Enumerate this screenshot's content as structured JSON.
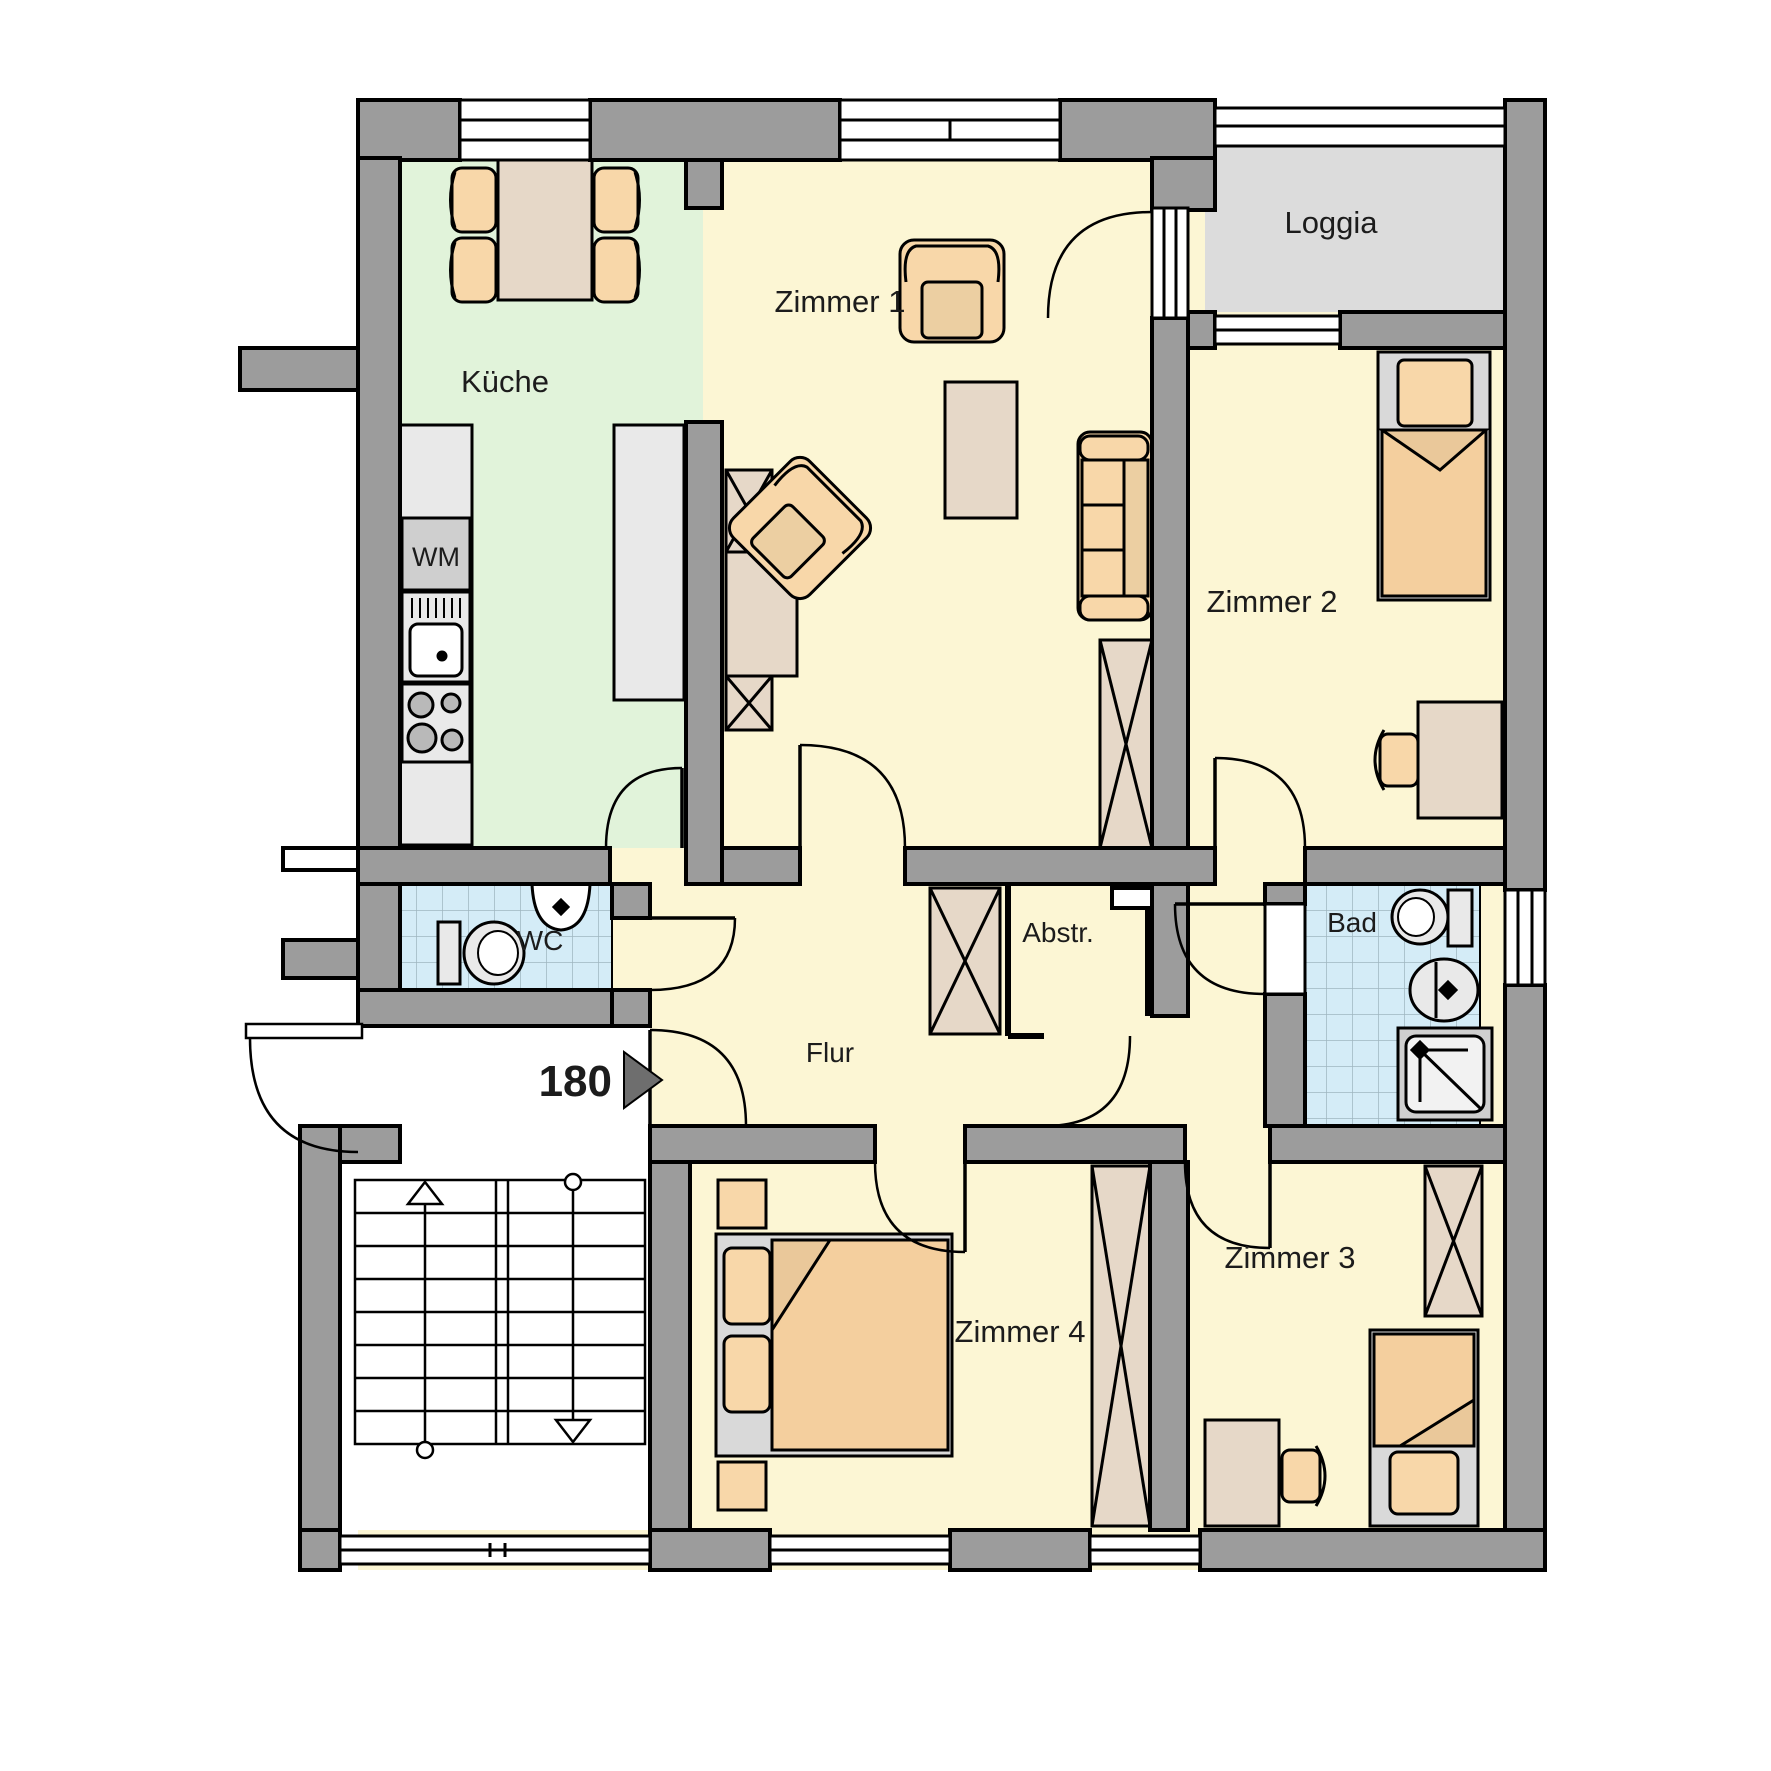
{
  "title": "Wohnungsgrundriss",
  "rooms": {
    "zimmer1": "Zimmer 1",
    "kueche": "Küche",
    "loggia": "Loggia",
    "zimmer2": "Zimmer 2",
    "wc": "WC",
    "bad": "Bad",
    "abstellraum": "Abstr.",
    "flur": "Flur",
    "zimmer4": "Zimmer 4",
    "zimmer3": "Zimmer 3"
  },
  "appliances": {
    "washing_machine": "WM"
  },
  "entrance": {
    "door_width_label": "180"
  },
  "icons": {
    "stair_up_arrow": "stair-direction-up",
    "stair_down_arrow": "stair-direction-down",
    "entrance_arrow": "entrance-direction-right"
  },
  "palette": {
    "wall_gray": "#9c9c9c",
    "outline_black": "#000000",
    "room_yellow": "#fcf6d4",
    "kitchen_green": "#e1f3da",
    "loggia_gray": "#dcdcdc",
    "tile_blue": "#d4ecf7",
    "tile_grid": "#9fb6c0",
    "furniture_orange": "#f8d7a9",
    "furniture_orange_shade": "#e6c497",
    "furniture_tan": "#e6d8c8",
    "appliance_gray": "#e9e9e9",
    "appliance_gray_dark": "#cfcfcf",
    "bed_frame_gray": "#d9d9d9",
    "white": "#ffffff"
  }
}
